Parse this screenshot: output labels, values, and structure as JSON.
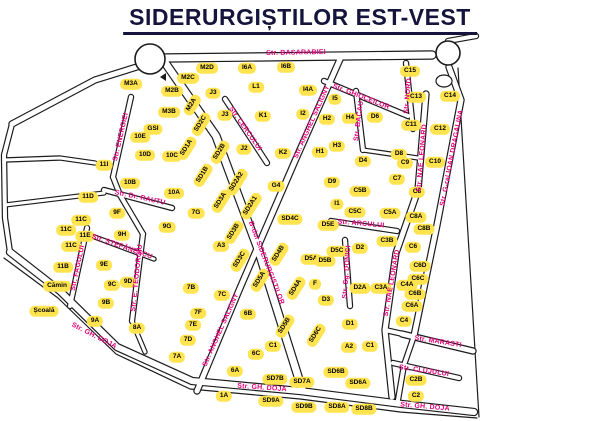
{
  "title": "SIDERURGIȘTILOR EST-VEST",
  "map": {
    "colors": {
      "background": "#ffffff",
      "road": "#ffffff",
      "outline": "#1c1c1c",
      "building": "#ffe44f",
      "building_text": "#000000",
      "street_label": "#e0007a",
      "title_text": "#14143c"
    },
    "roundabouts": [
      {
        "cx": 150,
        "cy": 59,
        "r": 15
      },
      {
        "cx": 448,
        "cy": 53,
        "r": 12
      }
    ],
    "islands": [
      {
        "cx": 444,
        "cy": 81,
        "rx": 8,
        "ry": 6
      }
    ],
    "markers": [
      {
        "type": "triangle-left",
        "x": 160,
        "y": 73
      }
    ],
    "roads": [
      {
        "points": [
          [
            164,
            58
          ],
          [
            432,
            55
          ]
        ],
        "w": 7
      },
      {
        "points": [
          [
            140,
            66
          ],
          [
            95,
            80
          ],
          [
            12,
            124
          ]
        ],
        "w": 5
      },
      {
        "points": [
          [
            12,
            124
          ],
          [
            4,
            155
          ],
          [
            5,
            218
          ],
          [
            10,
            252
          ]
        ],
        "w": 4
      },
      {
        "points": [
          [
            10,
            252
          ],
          [
            60,
            291
          ],
          [
            117,
            347
          ],
          [
            192,
            381
          ],
          [
            300,
            391
          ],
          [
            402,
            404
          ],
          [
            474,
            412
          ]
        ],
        "w": 6
      },
      {
        "points": [
          [
            4,
            258
          ],
          [
            58,
            298
          ],
          [
            116,
            354
          ],
          [
            190,
            389
          ],
          [
            300,
            399
          ],
          [
            400,
            412
          ],
          [
            477,
            418
          ]
        ],
        "w": 1,
        "border": true
      },
      {
        "points": [
          [
            458,
            68
          ],
          [
            479,
            417
          ]
        ],
        "w": 1,
        "border": true
      },
      {
        "points": [
          [
            449,
            67
          ],
          [
            461,
            100
          ],
          [
            437,
            225
          ],
          [
            414,
            336
          ]
        ],
        "w": 5
      },
      {
        "points": [
          [
            414,
            336
          ],
          [
            404,
            365
          ],
          [
            398,
            400
          ]
        ],
        "w": 4
      },
      {
        "points": [
          [
            166,
            64
          ],
          [
            216,
            136
          ],
          [
            258,
            249
          ],
          [
            302,
            389
          ]
        ],
        "w": 7
      },
      {
        "points": [
          [
            341,
            57
          ],
          [
            295,
            161
          ],
          [
            240,
            288
          ],
          [
            197,
            391
          ]
        ],
        "w": 5
      },
      {
        "points": [
          [
            426,
            94
          ],
          [
            418,
            190
          ],
          [
            396,
            253
          ],
          [
            385,
            330
          ],
          [
            392,
            397
          ]
        ],
        "w": 5
      },
      {
        "points": [
          [
            324,
            81
          ],
          [
            408,
            116
          ]
        ],
        "w": 4
      },
      {
        "points": [
          [
            356,
            91
          ],
          [
            363,
            150
          ]
        ],
        "w": 4
      },
      {
        "points": [
          [
            225,
            99
          ],
          [
            267,
            163
          ]
        ],
        "w": 4
      },
      {
        "points": [
          [
            331,
            221
          ],
          [
            397,
            231
          ]
        ],
        "w": 4
      },
      {
        "points": [
          [
            345,
            240
          ],
          [
            350,
            306
          ]
        ],
        "w": 4
      },
      {
        "points": [
          [
            104,
            190
          ],
          [
            172,
            208
          ]
        ],
        "w": 4
      },
      {
        "points": [
          [
            131,
            97
          ],
          [
            113,
            177
          ]
        ],
        "w": 4
      },
      {
        "points": [
          [
            87,
            228
          ],
          [
            70,
            306
          ]
        ],
        "w": 4
      },
      {
        "points": [
          [
            143,
            234
          ],
          [
            132,
            321
          ]
        ],
        "w": 4
      },
      {
        "points": [
          [
            92,
            236
          ],
          [
            154,
            259
          ]
        ],
        "w": 3
      },
      {
        "points": [
          [
            402,
            334
          ],
          [
            473,
            351
          ]
        ],
        "w": 5
      },
      {
        "points": [
          [
            393,
            363
          ],
          [
            459,
            378
          ]
        ],
        "w": 4
      },
      {
        "points": [
          [
            406,
            63
          ],
          [
            413,
            129
          ]
        ],
        "w": 4
      },
      {
        "points": [
          [
            4,
            160
          ],
          [
            60,
            158
          ],
          [
            95,
            163
          ]
        ],
        "w": 3
      },
      {
        "points": [
          [
            5,
            205
          ],
          [
            104,
            193
          ]
        ],
        "w": 3
      },
      {
        "points": [
          [
            113,
            177
          ],
          [
            120,
            195
          ],
          [
            143,
            234
          ]
        ],
        "w": 4
      },
      {
        "points": [
          [
            132,
            321
          ],
          [
            145,
            352
          ]
        ],
        "w": 3
      },
      {
        "points": [
          [
            363,
            150
          ],
          [
            418,
            158
          ]
        ],
        "w": 3
      },
      {
        "points": [
          [
            385,
            330
          ],
          [
            403,
            334
          ]
        ],
        "w": 4
      },
      {
        "points": [
          [
            448,
            41
          ],
          [
            476,
            36
          ]
        ],
        "w": 4
      }
    ],
    "streets": [
      {
        "name": "Str. BASARABIEI",
        "x": 296,
        "y": 53,
        "rot": -1
      },
      {
        "name": "Str. GHIOCEILOR",
        "x": 361,
        "y": 97,
        "rot": 21
      },
      {
        "name": "Str. BACAU",
        "x": 359,
        "y": 121,
        "rot": -83
      },
      {
        "name": "Str. CERCULUI",
        "x": 245,
        "y": 129,
        "rot": 55
      },
      {
        "name": "Str. ANGHEL SALIGNY",
        "x": 312,
        "y": 122,
        "rot": -66
      },
      {
        "name": "Str. ANGHEL SALIGNY",
        "x": 221,
        "y": 330,
        "rot": -66
      },
      {
        "name": "B-dul SIDERURGISTILOR",
        "x": 266,
        "y": 263,
        "rot": 69
      },
      {
        "name": "Str. NAE LEONARD",
        "x": 422,
        "y": 158,
        "rot": -85
      },
      {
        "name": "Str. NAE LEONARD",
        "x": 392,
        "y": 283,
        "rot": -80
      },
      {
        "name": "Str. G-ral IOAN DRAGALINA",
        "x": 452,
        "y": 158,
        "rot": -79
      },
      {
        "name": "Str. NORD",
        "x": 408,
        "y": 96,
        "rot": -85
      },
      {
        "name": "Str. Dr. RAUTU",
        "x": 140,
        "y": 198,
        "rot": 12
      },
      {
        "name": "Str. ENERGIEI",
        "x": 121,
        "y": 137,
        "rot": -77
      },
      {
        "name": "Str. FAGULUI",
        "x": 78,
        "y": 268,
        "rot": -78
      },
      {
        "name": "Str. E. TEODOROIU",
        "x": 137,
        "y": 278,
        "rot": -84
      },
      {
        "name": "Str. ȘTEFĂNESCU",
        "x": 122,
        "y": 247,
        "rot": 19
      },
      {
        "name": "Str. GH. DOJA",
        "x": 94,
        "y": 336,
        "rot": 27
      },
      {
        "name": "Str. GH. DOJA",
        "x": 262,
        "y": 388,
        "rot": 4
      },
      {
        "name": "Str. GH. DOJA",
        "x": 425,
        "y": 407,
        "rot": 5
      },
      {
        "name": "Str. MARASTI",
        "x": 438,
        "y": 342,
        "rot": 9
      },
      {
        "name": "Str. CLUJULUI",
        "x": 424,
        "y": 371,
        "rot": 8
      },
      {
        "name": "Str. ARCULUI",
        "x": 361,
        "y": 224,
        "rot": 5
      },
      {
        "name": "Str. Sg. DONICI",
        "x": 347,
        "y": 272,
        "rot": -86
      }
    ],
    "buildings": [
      {
        "label": "M3A",
        "x": 131,
        "y": 84
      },
      {
        "label": "M2D",
        "x": 207,
        "y": 68
      },
      {
        "label": "M2C",
        "x": 188,
        "y": 78
      },
      {
        "label": "M2B",
        "x": 172,
        "y": 91
      },
      {
        "label": "M2A",
        "x": 192,
        "y": 105,
        "rot": -58
      },
      {
        "label": "M3B",
        "x": 169,
        "y": 112
      },
      {
        "label": "SD2C",
        "x": 201,
        "y": 124,
        "rot": -58
      },
      {
        "label": "GSI",
        "x": 153,
        "y": 129
      },
      {
        "label": "10E",
        "x": 140,
        "y": 137
      },
      {
        "label": "11I",
        "x": 104,
        "y": 165
      },
      {
        "label": "10D",
        "x": 145,
        "y": 155
      },
      {
        "label": "10C",
        "x": 172,
        "y": 156
      },
      {
        "label": "SD1A",
        "x": 187,
        "y": 148,
        "rot": -58
      },
      {
        "label": "10B",
        "x": 130,
        "y": 183
      },
      {
        "label": "10A",
        "x": 174,
        "y": 193
      },
      {
        "label": "11D",
        "x": 88,
        "y": 197
      },
      {
        "label": "9F",
        "x": 117,
        "y": 213
      },
      {
        "label": "7G",
        "x": 196,
        "y": 213
      },
      {
        "label": "9G",
        "x": 167,
        "y": 227
      },
      {
        "label": "9H",
        "x": 122,
        "y": 235
      },
      {
        "label": "11C",
        "x": 81,
        "y": 220
      },
      {
        "label": "11C",
        "x": 66,
        "y": 230
      },
      {
        "label": "11E",
        "x": 85,
        "y": 236
      },
      {
        "label": "11C",
        "x": 71,
        "y": 246
      },
      {
        "label": "11B",
        "x": 63,
        "y": 267
      },
      {
        "label": "Cămin",
        "x": 57,
        "y": 286
      },
      {
        "label": "Școală",
        "x": 44,
        "y": 311
      },
      {
        "label": "9E",
        "x": 104,
        "y": 265
      },
      {
        "label": "9D",
        "x": 128,
        "y": 282
      },
      {
        "label": "9C",
        "x": 112,
        "y": 285
      },
      {
        "label": "9B",
        "x": 106,
        "y": 303
      },
      {
        "label": "9A",
        "x": 95,
        "y": 321
      },
      {
        "label": "8A",
        "x": 137,
        "y": 328
      },
      {
        "label": "7B",
        "x": 191,
        "y": 288
      },
      {
        "label": "7C",
        "x": 222,
        "y": 295
      },
      {
        "label": "7F",
        "x": 198,
        "y": 313
      },
      {
        "label": "7E",
        "x": 193,
        "y": 325
      },
      {
        "label": "7D",
        "x": 188,
        "y": 340
      },
      {
        "label": "7A",
        "x": 177,
        "y": 357
      },
      {
        "label": "A3",
        "x": 221,
        "y": 246
      },
      {
        "label": "SD1B",
        "x": 203,
        "y": 175,
        "rot": -58
      },
      {
        "label": "SD2B",
        "x": 220,
        "y": 152,
        "rot": -58
      },
      {
        "label": "SD2A2",
        "x": 237,
        "y": 182,
        "rot": -58
      },
      {
        "label": "SD3A",
        "x": 221,
        "y": 201,
        "rot": -58
      },
      {
        "label": "SD2A1",
        "x": 251,
        "y": 206,
        "rot": -58
      },
      {
        "label": "SD3B",
        "x": 234,
        "y": 232,
        "rot": -58
      },
      {
        "label": "SD3C",
        "x": 240,
        "y": 260,
        "rot": -58
      },
      {
        "label": "SD5A",
        "x": 260,
        "y": 280,
        "rot": -58
      },
      {
        "label": "SD4B",
        "x": 279,
        "y": 254,
        "rot": -58
      },
      {
        "label": "SD4C",
        "x": 290,
        "y": 219
      },
      {
        "label": "SD4A",
        "x": 296,
        "y": 288,
        "rot": -58
      },
      {
        "label": "SD5B",
        "x": 285,
        "y": 326,
        "rot": -58
      },
      {
        "label": "SD6C",
        "x": 316,
        "y": 335,
        "rot": -58
      },
      {
        "label": "6B",
        "x": 248,
        "y": 314
      },
      {
        "label": "6C",
        "x": 256,
        "y": 354
      },
      {
        "label": "C1",
        "x": 273,
        "y": 346
      },
      {
        "label": "6A",
        "x": 235,
        "y": 371
      },
      {
        "label": "1A",
        "x": 224,
        "y": 396
      },
      {
        "label": "SD7B",
        "x": 275,
        "y": 379
      },
      {
        "label": "SD7A",
        "x": 302,
        "y": 382
      },
      {
        "label": "SD9A",
        "x": 271,
        "y": 401
      },
      {
        "label": "SD9B",
        "x": 304,
        "y": 407
      },
      {
        "label": "SD8A",
        "x": 337,
        "y": 407
      },
      {
        "label": "SD8B",
        "x": 364,
        "y": 409
      },
      {
        "label": "SD6B",
        "x": 336,
        "y": 372
      },
      {
        "label": "SD6A",
        "x": 358,
        "y": 383
      },
      {
        "label": "J3",
        "x": 213,
        "y": 93
      },
      {
        "label": "J3",
        "x": 225,
        "y": 115
      },
      {
        "label": "K1",
        "x": 263,
        "y": 116
      },
      {
        "label": "J2",
        "x": 244,
        "y": 149
      },
      {
        "label": "K2",
        "x": 283,
        "y": 153
      },
      {
        "label": "G4",
        "x": 276,
        "y": 186
      },
      {
        "label": "L1",
        "x": 256,
        "y": 87
      },
      {
        "label": "I6A",
        "x": 247,
        "y": 68
      },
      {
        "label": "I6B",
        "x": 286,
        "y": 67
      },
      {
        "label": "I4A",
        "x": 308,
        "y": 90
      },
      {
        "label": "I5",
        "x": 335,
        "y": 99
      },
      {
        "label": "I2",
        "x": 303,
        "y": 114
      },
      {
        "label": "H2",
        "x": 327,
        "y": 119
      },
      {
        "label": "H4",
        "x": 350,
        "y": 118
      },
      {
        "label": "D6",
        "x": 375,
        "y": 117
      },
      {
        "label": "H3",
        "x": 337,
        "y": 146
      },
      {
        "label": "H1",
        "x": 320,
        "y": 152
      },
      {
        "label": "D4",
        "x": 363,
        "y": 161
      },
      {
        "label": "D9",
        "x": 332,
        "y": 182
      },
      {
        "label": "I1",
        "x": 337,
        "y": 204
      },
      {
        "label": "D8",
        "x": 399,
        "y": 154
      },
      {
        "label": "C9",
        "x": 405,
        "y": 163
      },
      {
        "label": "C7",
        "x": 397,
        "y": 179
      },
      {
        "label": "C8",
        "x": 417,
        "y": 192
      },
      {
        "label": "C10",
        "x": 435,
        "y": 162
      },
      {
        "label": "C11",
        "x": 411,
        "y": 125
      },
      {
        "label": "C12",
        "x": 440,
        "y": 129
      },
      {
        "label": "C13",
        "x": 416,
        "y": 97
      },
      {
        "label": "C14",
        "x": 450,
        "y": 96
      },
      {
        "label": "C15",
        "x": 410,
        "y": 71
      },
      {
        "label": "C5B",
        "x": 360,
        "y": 191
      },
      {
        "label": "C5C",
        "x": 355,
        "y": 212
      },
      {
        "label": "C5A",
        "x": 390,
        "y": 213
      },
      {
        "label": "C8A",
        "x": 416,
        "y": 217
      },
      {
        "label": "C8B",
        "x": 424,
        "y": 229
      },
      {
        "label": "D5E",
        "x": 328,
        "y": 225
      },
      {
        "label": "D5A",
        "x": 311,
        "y": 259
      },
      {
        "label": "D5B",
        "x": 325,
        "y": 261
      },
      {
        "label": "D5C",
        "x": 337,
        "y": 251
      },
      {
        "label": "F",
        "x": 315,
        "y": 284
      },
      {
        "label": "D3",
        "x": 326,
        "y": 300
      },
      {
        "label": "D1",
        "x": 350,
        "y": 324
      },
      {
        "label": "D2",
        "x": 360,
        "y": 248
      },
      {
        "label": "C3B",
        "x": 387,
        "y": 241
      },
      {
        "label": "C6",
        "x": 413,
        "y": 247
      },
      {
        "label": "C6D",
        "x": 420,
        "y": 266
      },
      {
        "label": "C6C",
        "x": 418,
        "y": 279
      },
      {
        "label": "C4A",
        "x": 407,
        "y": 285
      },
      {
        "label": "C6B",
        "x": 415,
        "y": 294
      },
      {
        "label": "C6A",
        "x": 412,
        "y": 306
      },
      {
        "label": "C4",
        "x": 404,
        "y": 321
      },
      {
        "label": "D2A",
        "x": 360,
        "y": 288
      },
      {
        "label": "C3A",
        "x": 381,
        "y": 288
      },
      {
        "label": "A2",
        "x": 349,
        "y": 347
      },
      {
        "label": "C1",
        "x": 370,
        "y": 346
      },
      {
        "label": "C2B",
        "x": 416,
        "y": 380
      },
      {
        "label": "C2",
        "x": 416,
        "y": 396
      }
    ]
  }
}
